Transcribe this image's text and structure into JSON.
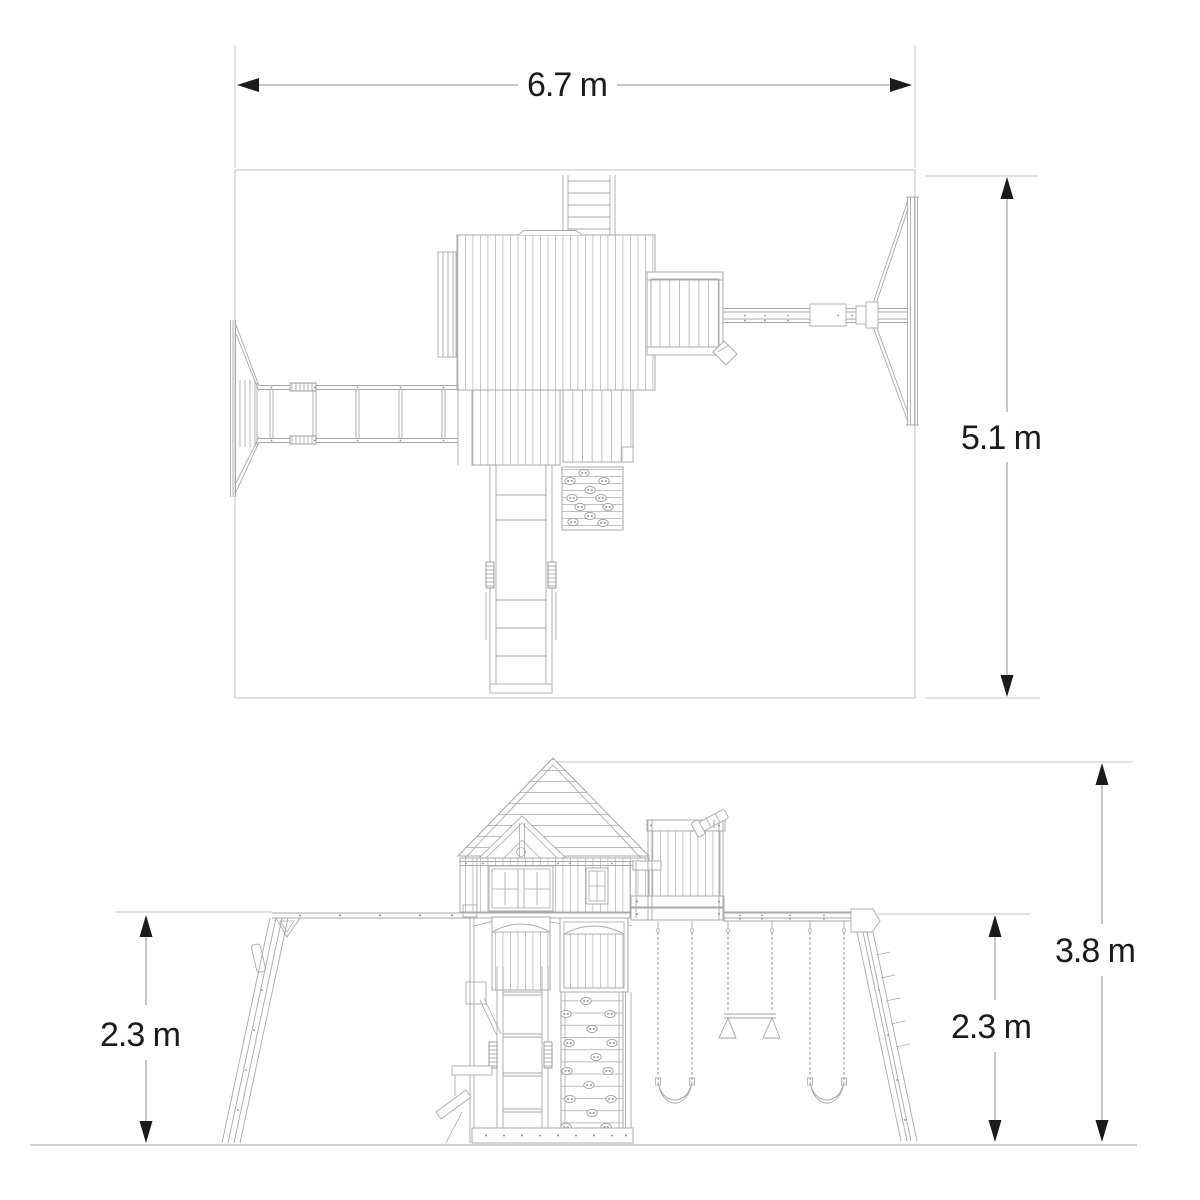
{
  "diagram": {
    "kind": "playset dimension drawing",
    "views": {
      "top_view": {
        "width_label": "6.7 m",
        "depth_label": "5.1 m"
      },
      "side_view": {
        "left_height_label": "2.3 m",
        "overall_height_label": "3.8 m",
        "right_height_label": "2.3 m"
      }
    },
    "colors": {
      "background": "#ffffff",
      "drawing_line": "#a9a9a9",
      "light_line": "#c6c6c6",
      "dimension_line": "#8c8c8c",
      "ink": "#1b1b1b"
    }
  }
}
